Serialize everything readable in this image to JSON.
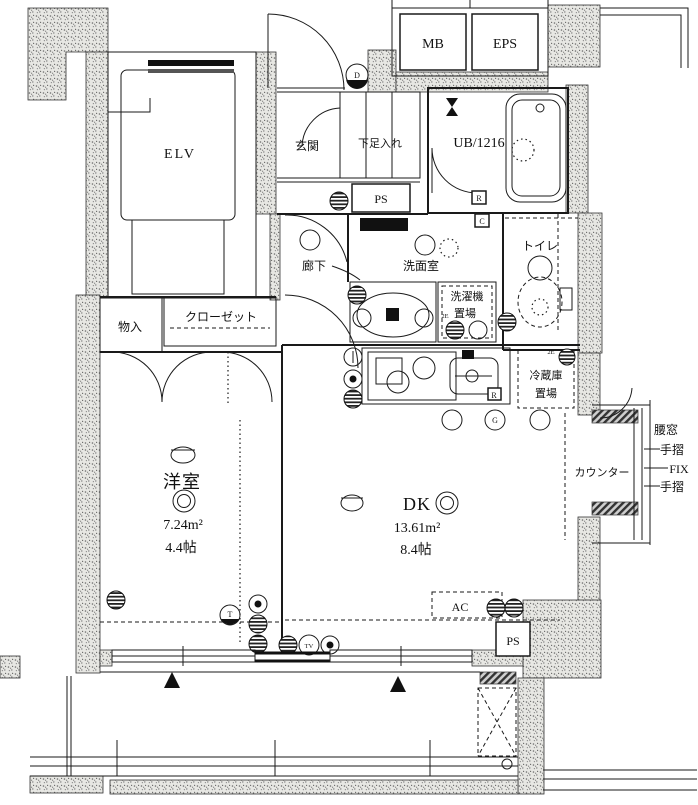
{
  "plan": {
    "rooms": {
      "elevator": "ELV",
      "meter_box": "MB",
      "eps": "EPS",
      "entrance": "玄関",
      "shoe_cabinet": "下足入れ",
      "unit_bath": "UB/1216",
      "pipe_space_top": "PS",
      "hallway": "廊下",
      "washroom": "洗面室",
      "toilet": "トイレ",
      "laundry_line1": "洗濯機",
      "laundry_line2": "置場",
      "storage": "物入",
      "closet": "クローゼット",
      "western_room": {
        "name": "洋室",
        "area_m2": "7.24m²",
        "area_jo": "4.4帖"
      },
      "dining_kitchen": {
        "name": "DK",
        "area_m2": "13.61m²",
        "area_jo": "8.4帖"
      },
      "fridge_line1": "冷蔵庫",
      "fridge_line2": "置場",
      "counter": "カウンター",
      "ac_unit": "AC",
      "pipe_space_bottom": "PS"
    },
    "window_annotations": {
      "waist_window": "腰窓",
      "handrail_top": "手摺",
      "fix_window": "FIX",
      "handrail_bottom": "手摺"
    },
    "markers": {
      "doorbell": "D",
      "ub_r": "R",
      "ub_c": "C",
      "kitchen_r": "R",
      "gas": "G",
      "tv_outlet": "TV",
      "phone_outlet": "T",
      "outlet_2e_laundry": "2E",
      "outlet_2e_fridge": "2E"
    },
    "colors": {
      "wall_fill": "#e7e7e3",
      "line": "#1a1a1a"
    }
  }
}
